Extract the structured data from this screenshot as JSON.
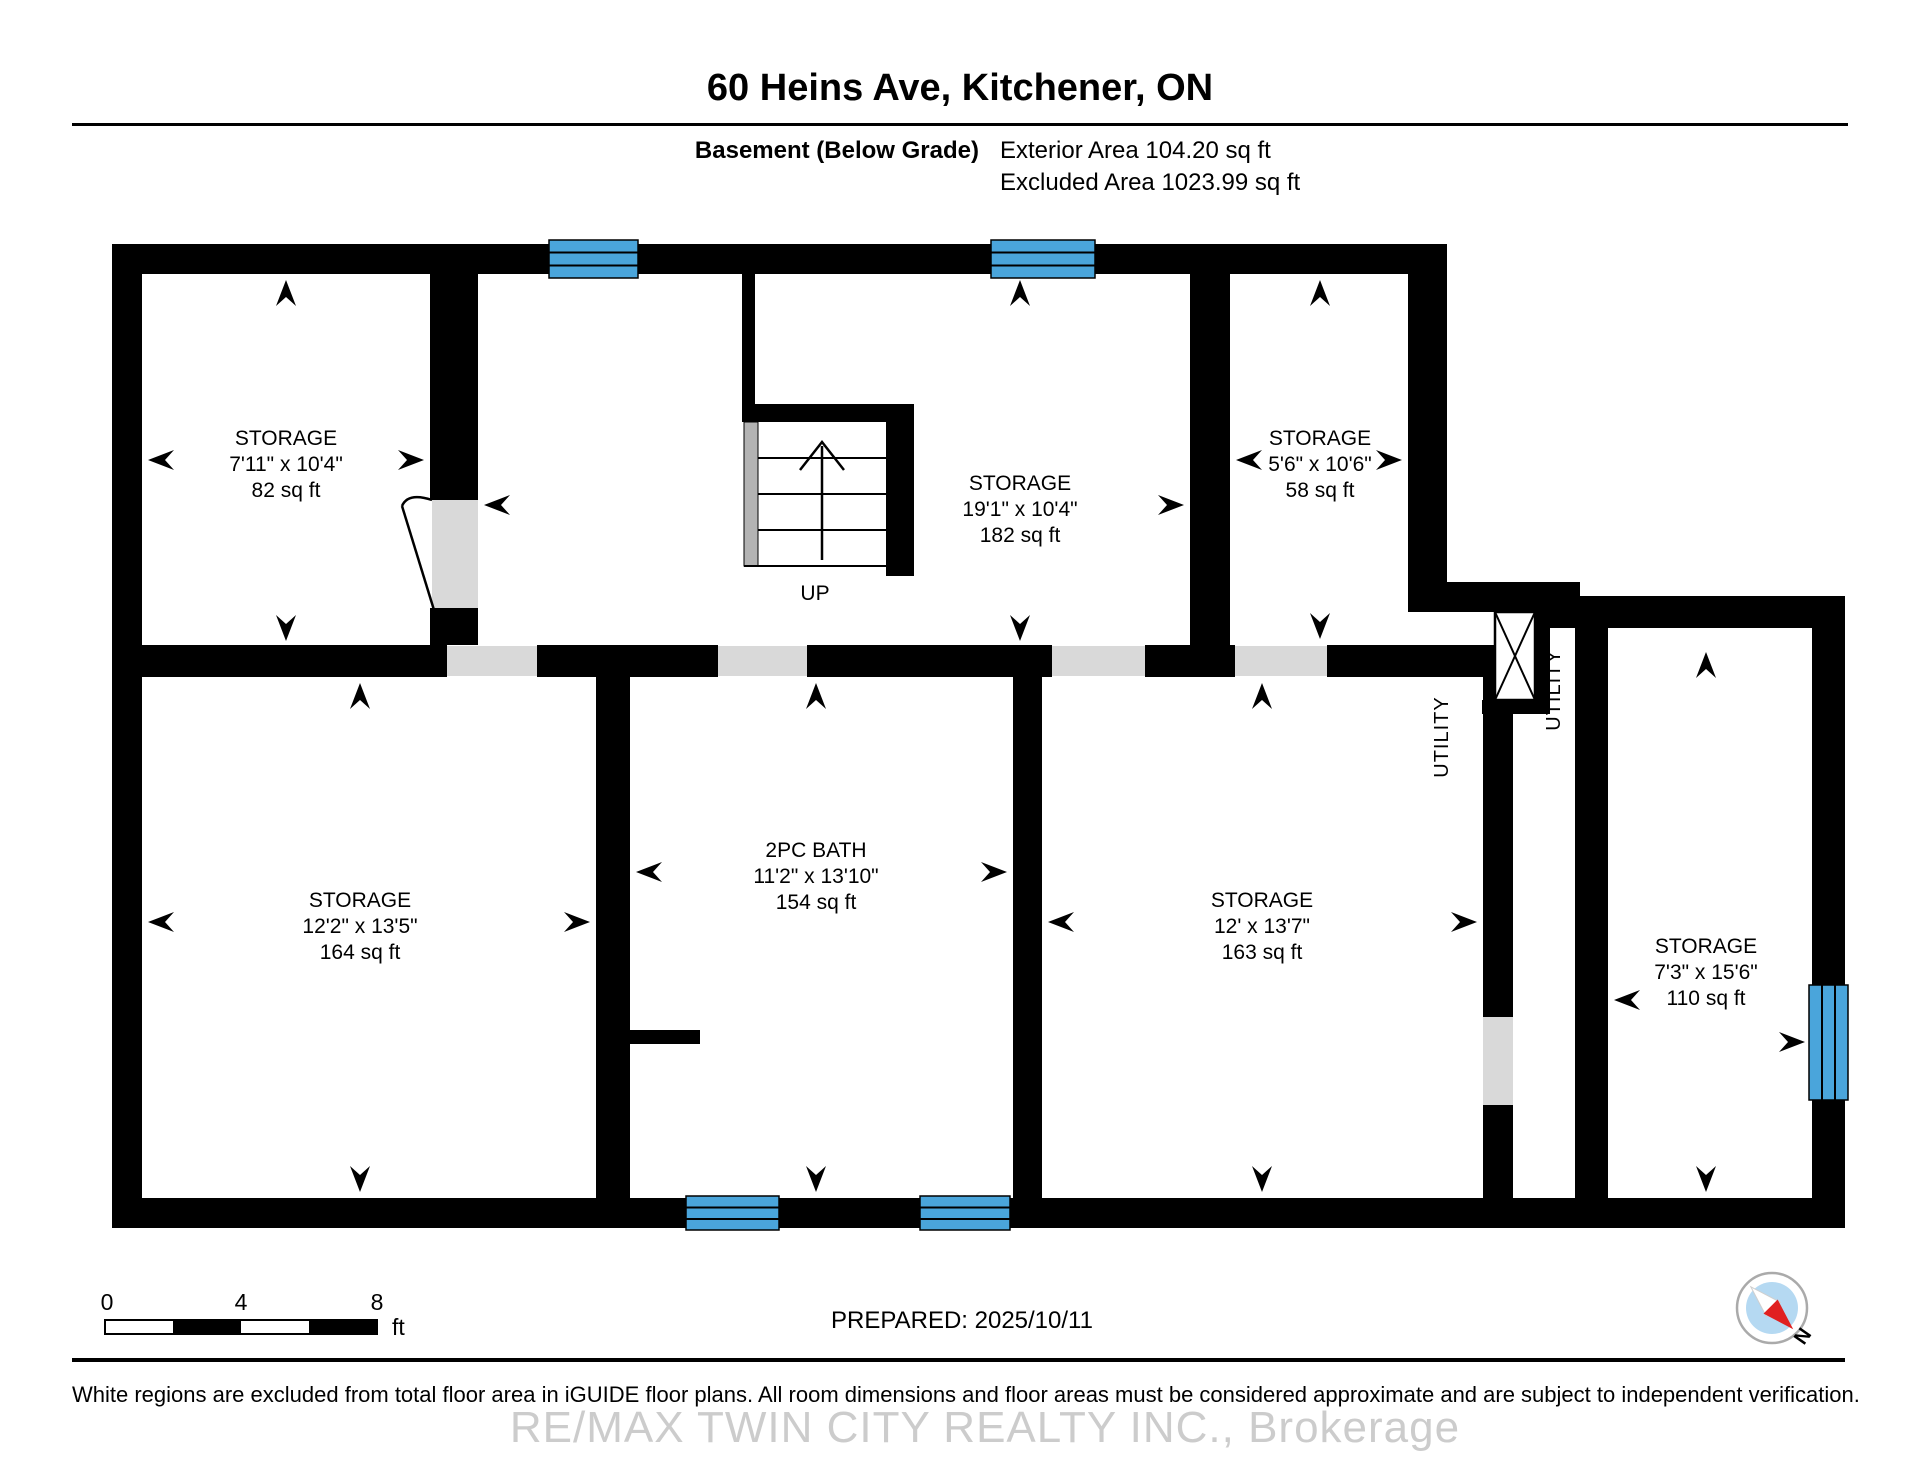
{
  "header": {
    "title": "60 Heins Ave, Kitchener, ON",
    "floor_label": "Basement (Below Grade)",
    "exterior_area": "Exterior Area 104.20 sq ft",
    "excluded_area": "Excluded Area 1023.99 sq ft"
  },
  "rooms": {
    "storage_82": {
      "name": "STORAGE",
      "dims": "7'11\" x 10'4\"",
      "area": "82 sq ft"
    },
    "storage_182": {
      "name": "STORAGE",
      "dims": "19'1\" x 10'4\"",
      "area": "182 sq ft"
    },
    "storage_58": {
      "name": "STORAGE",
      "dims": "5'6\" x 10'6\"",
      "area": "58 sq ft"
    },
    "storage_164": {
      "name": "STORAGE",
      "dims": "12'2\" x 13'5\"",
      "area": "164 sq ft"
    },
    "bath_154": {
      "name": "2PC BATH",
      "dims": "11'2\" x 13'10\"",
      "area": "154 sq ft"
    },
    "storage_163": {
      "name": "STORAGE",
      "dims": "12' x 13'7\"",
      "area": "163 sq ft"
    },
    "storage_110": {
      "name": "STORAGE",
      "dims": "7'3\" x 15'6\"",
      "area": "110 sq ft"
    }
  },
  "labels": {
    "up": "UP",
    "utility": "UTILITY"
  },
  "scale_bar": {
    "t0": "0",
    "t4": "4",
    "t8": "8",
    "unit": "ft"
  },
  "footer": {
    "prepared": "PREPARED: 2025/10/11",
    "north": "N",
    "disclaimer": "White regions are excluded from total floor area in iGUIDE floor plans. All room dimensions and floor areas must be considered approximate and are subject to independent verification.",
    "watermark": "RE/MAX TWIN CITY REALTY INC., Brokerage"
  },
  "colors": {
    "wall": "#000000",
    "window_blue": "#4aa5db",
    "door_gray": "#d9d9d9",
    "stair_gray": "#b3b3b3",
    "compass_disc": "#b5d9f2",
    "compass_red": "#e02020"
  }
}
